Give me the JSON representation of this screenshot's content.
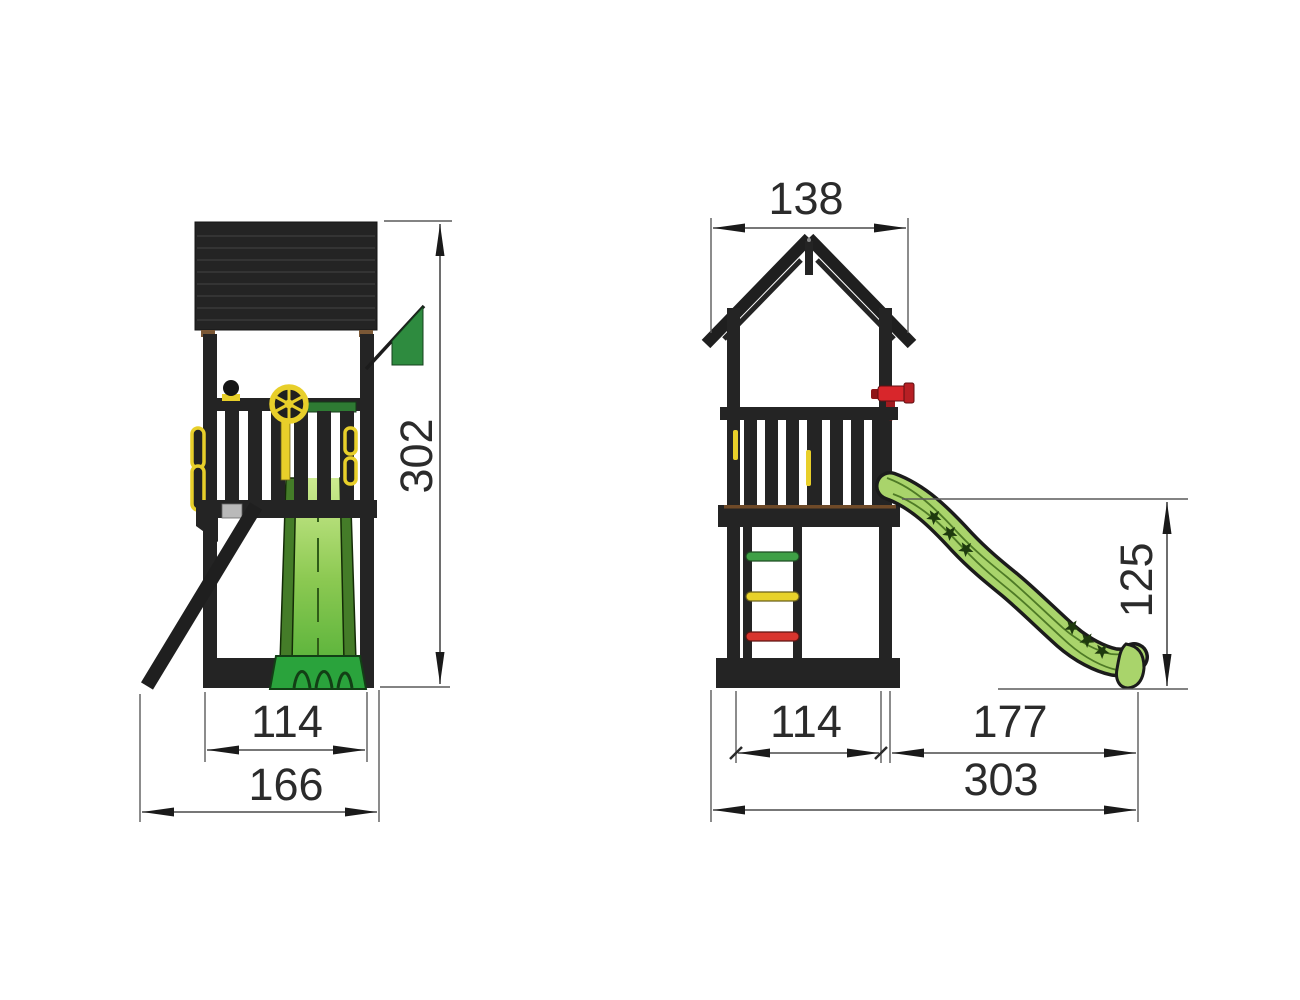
{
  "drawing": {
    "kind": "playground-tower-dimension-diagram",
    "side_view": {
      "dim_height": "302",
      "dim_platform_width": "114",
      "dim_total_depth": "166"
    },
    "front_view": {
      "dim_roof_width": "138",
      "dim_slide_height": "125",
      "dim_platform_width": "114",
      "dim_slide_length": "177",
      "dim_total_width": "303"
    }
  },
  "colors": {
    "background": "#ffffff",
    "frame_dark": "#242424",
    "roof_stripe": "#3a3a3a",
    "connector_brown": "#7b5836",
    "slide_green": "#a9d46b",
    "slide_rail_green": "#447c28",
    "slide_base_green": "#2aa33c",
    "flag_green": "#2e8b3f",
    "accent_yellow": "#e8cf2a",
    "telescope_red": "#d8262b",
    "rung_green": "#3fa046",
    "rung_yellow": "#e8d22a",
    "rung_red": "#d8352e",
    "dim_line": "#4a4a4a",
    "text": "#2b2b2b",
    "gray_block": "#b9b9b9"
  }
}
